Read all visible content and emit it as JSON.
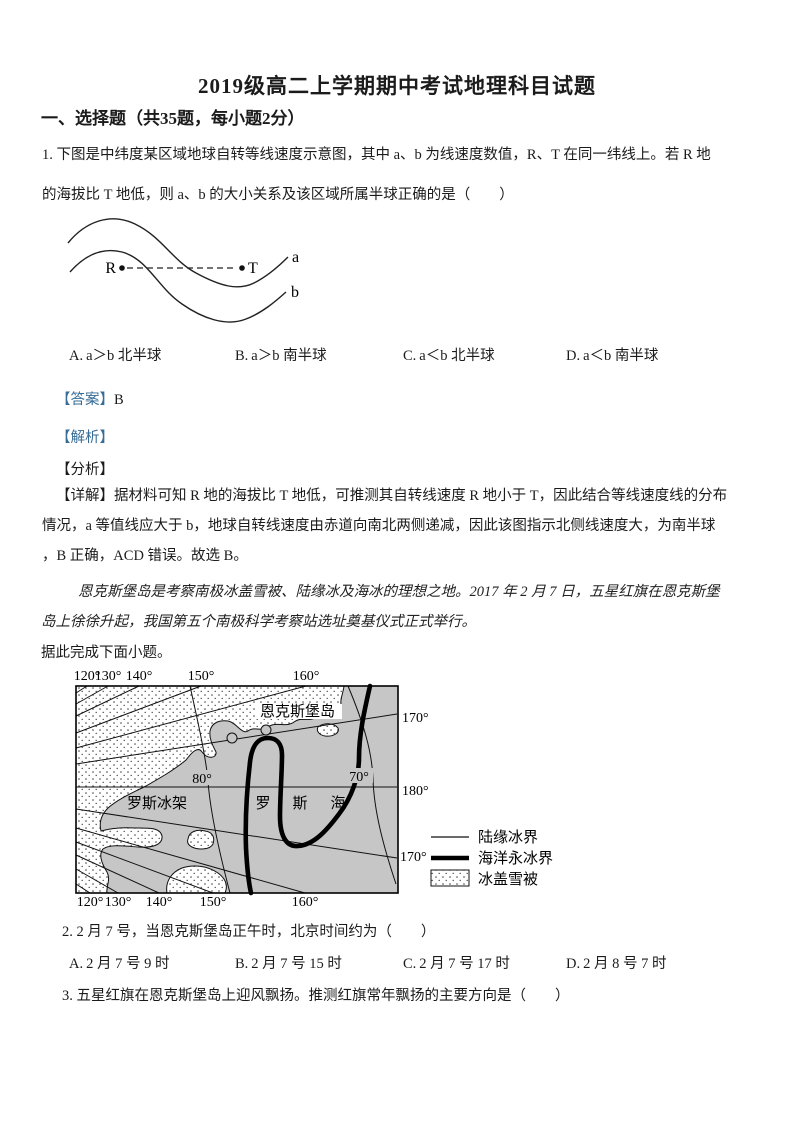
{
  "doc": {
    "title": "2019级高二上学期期中考试地理科目试题",
    "section": "一、选择题（共35题，每小题2分）"
  },
  "q1": {
    "line1": "1. 下图是中纬度某区域地球自转等线速度示意图，其中 a、b 为线速度数值，R、T 在同一纬线上。若 R 地",
    "line2": "的海拔比 T 地低，则 a、b 的大小关系及该区域所属半球正确的是（　　）",
    "figure": {
      "r": "R",
      "t": "T",
      "a": "a",
      "b": "b"
    },
    "options": [
      {
        "label": "A.",
        "text": "a＞b 北半球"
      },
      {
        "label": "B.",
        "text": "a＞b 南半球"
      },
      {
        "label": "C.",
        "text": "a＜b 北半球"
      },
      {
        "label": "D.",
        "text": "a＜b 南半球"
      }
    ]
  },
  "explain": {
    "answer_tag": "【答案】",
    "answer": "B",
    "jiexi_tag": "【解析】",
    "fenxi_tag": "【分析】",
    "xiangjie_line1": "【详解】据材料可知 R 地的海拔比 T 地低，可推测其自转线速度 R 地小于 T，因此结合等线速度线的分布",
    "xiangjie_line2": "情况，a 等值线应大于 b，地球自转线速度由赤道向南北两侧递减，因此该图指示北侧线速度大，为南半球",
    "xiangjie_line3": "，B 正确，ACD 错误。故选 B。"
  },
  "passage": {
    "line1": "恩克斯堡岛是考察南极冰盖雪被、陆缘冰及海冰的理想之地。2017 年 2 月 7 日，五星红旗在恩克斯堡",
    "line2": "岛上徐徐升起，我国第五个南极科学考察站选址奠基仪式正式举行。",
    "lead": "据此完成下面小题。"
  },
  "map": {
    "top_labels": [
      "120°",
      "130°",
      "140°",
      "150°",
      "160°"
    ],
    "bottom_labels": [
      "120°",
      "130°",
      "140°",
      "150°",
      "160°"
    ],
    "right_labels": [
      "170°",
      "180°",
      "170°"
    ],
    "island_label": "恩克斯堡岛",
    "lat80": "80°",
    "lat70": "70°",
    "ice_shelf": "罗斯冰架",
    "sea_char1": "罗",
    "sea_char2": "斯",
    "sea_char3": "海",
    "legend": {
      "land_edge": "陆缘冰界",
      "sea_ice_edge": "海洋永冰界",
      "ice_sheet": "冰盖雪被"
    }
  },
  "q2": {
    "text": "2. 2 月 7 号，当恩克斯堡岛正午时，北京时间约为（　　）",
    "options": [
      {
        "label": "A.",
        "text": "2 月 7 号 9 时"
      },
      {
        "label": "B.",
        "text": "2 月 7 号 15 时"
      },
      {
        "label": "C.",
        "text": "2 月 7 号 17 时"
      },
      {
        "label": "D.",
        "text": "2 月 8 号 7 时"
      }
    ]
  },
  "q3": {
    "text": "3. 五星红旗在恩克斯堡岛上迎风飘扬。推测红旗常年飘扬的主要方向是（　　）"
  },
  "colors": {
    "tag_blue": "#366c96",
    "sea_gray": "#c6c6c6"
  }
}
